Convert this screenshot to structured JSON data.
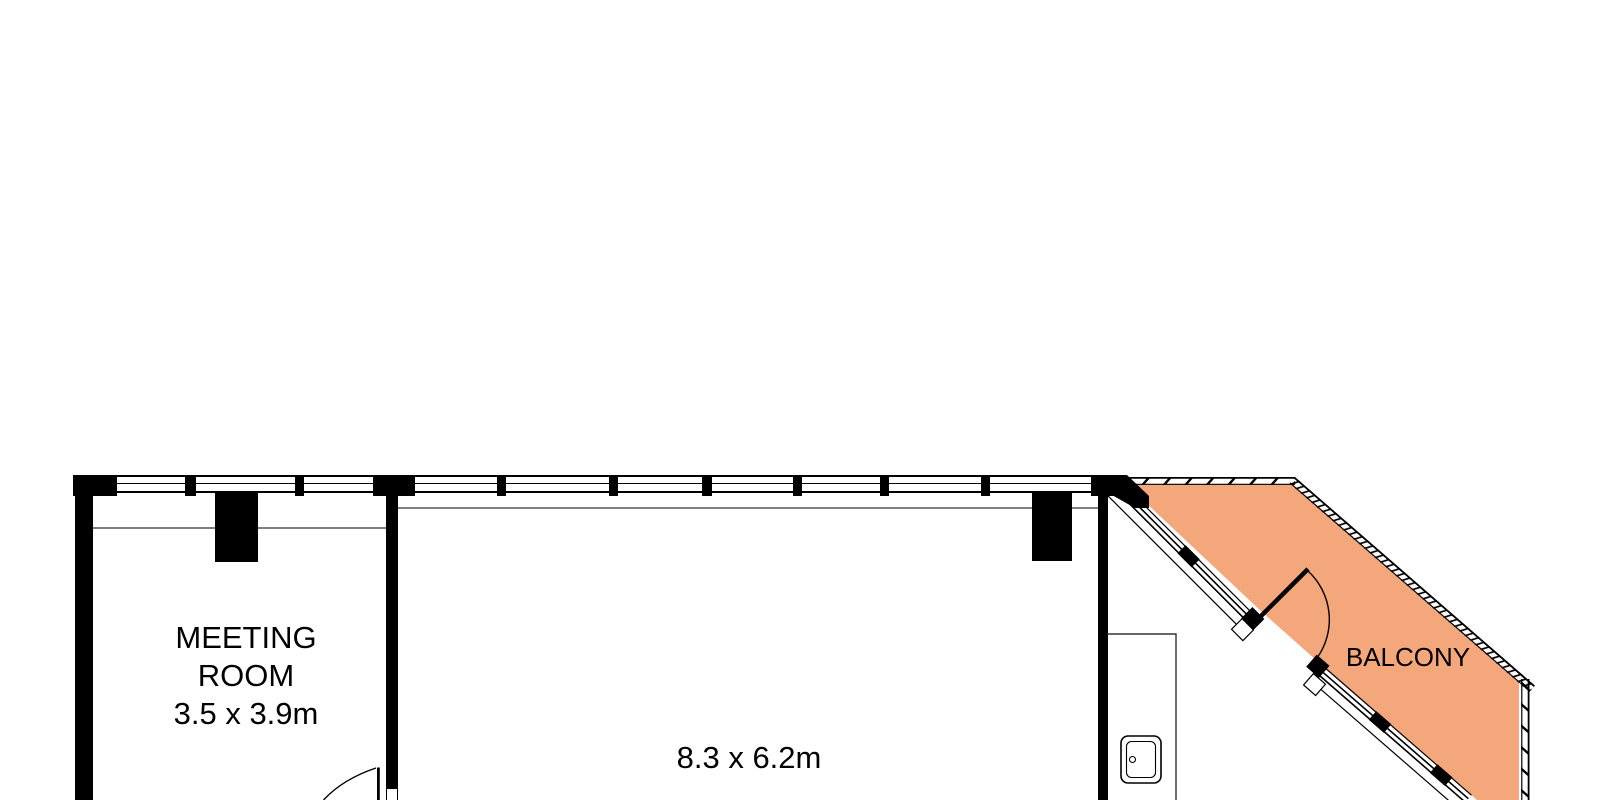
{
  "rooms": {
    "meeting": {
      "label": "MEETING\nROOM",
      "dims": "3.5 x 3.9m"
    },
    "main": {
      "dims": "8.3 x 6.2m"
    },
    "balcony": {
      "label": "BALCONY"
    }
  },
  "colors": {
    "wall": "#000000",
    "balcony_fill": "#F5A77C",
    "ceiling_line_gray": "#7F7F7F",
    "background": "#FFFFFF"
  }
}
